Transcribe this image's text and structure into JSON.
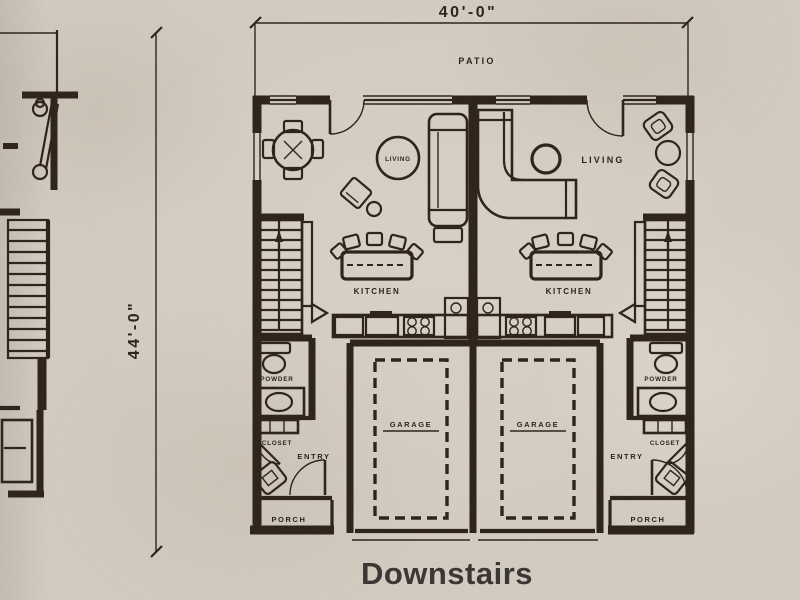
{
  "floor": {
    "title": "Downstairs"
  },
  "dimensions": {
    "width": "40'-0\"",
    "depth": "44'-0\""
  },
  "areas": {
    "patio": "PATIO"
  },
  "units": [
    {
      "living": "LIVING",
      "kitchen": "KITCHEN",
      "garage": "GARAGE",
      "powder": "POWDER",
      "closet": "CLOSET",
      "entry": "ENTRY",
      "porch": "PORCH"
    },
    {
      "living": "LIVING",
      "kitchen": "KITCHEN",
      "garage": "GARAGE",
      "powder": "POWDER",
      "closet": "CLOSET",
      "entry": "ENTRY",
      "porch": "PORCH"
    }
  ],
  "colors": {
    "paper": "#d5cdc2",
    "ink": "#2a2016",
    "title_ink": "#3b3734"
  }
}
